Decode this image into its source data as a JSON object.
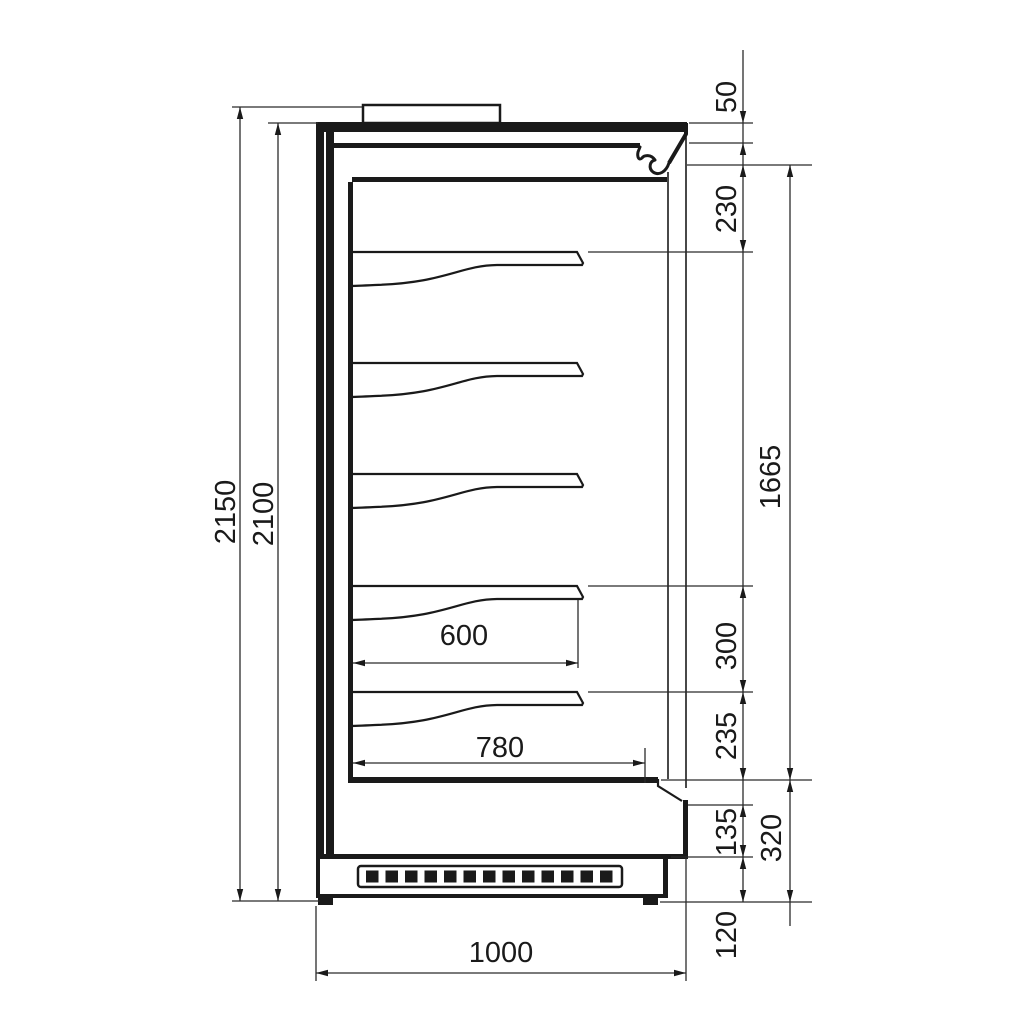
{
  "drawing": {
    "dimensions_mm": {
      "overall_height": "2150",
      "body_height": "2100",
      "canopy_front_height": "50",
      "canopy_to_first_shelf": "230",
      "display_opening_height": "1665",
      "shelf_spacing": "300",
      "last_shelf_to_well_floor": "235",
      "front_lower_panel": "135",
      "base_section_height": "320",
      "plinth_height": "120",
      "shelf_depth": "600",
      "well_floor_depth": "780",
      "overall_depth": "1000"
    }
  },
  "colors": {
    "line": "#1a1a1a",
    "dim_line": "#2b2b2b",
    "background": "#ffffff"
  }
}
